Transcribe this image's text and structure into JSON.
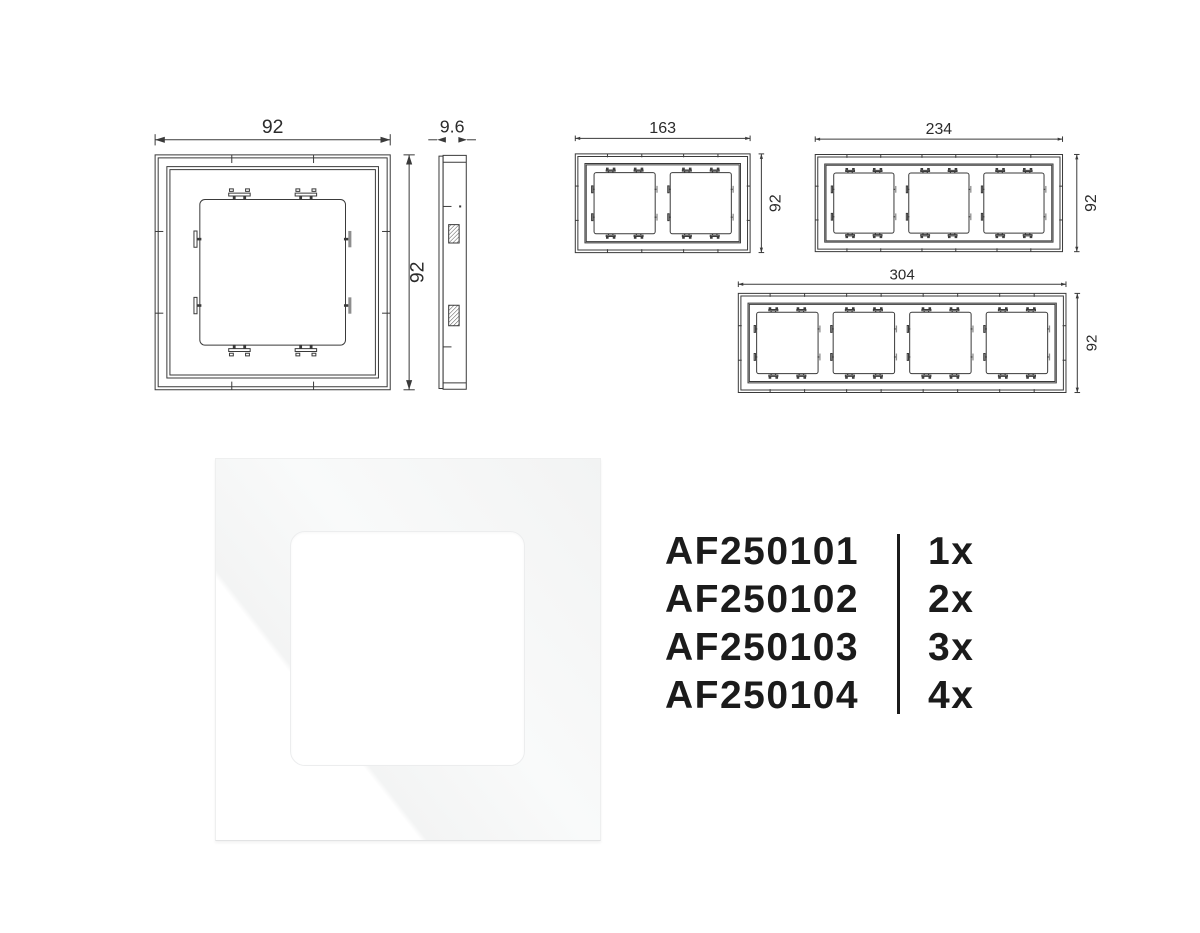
{
  "colors": {
    "background": "#ffffff",
    "drawing_line": "#3a3a3a",
    "dimension_text": "#2b2b2b",
    "table_text": "#1b1b1b"
  },
  "dimensions": {
    "front_1gang": {
      "width": "92",
      "height": "92"
    },
    "side_view": {
      "depth": "9.6"
    },
    "front_2gang": {
      "width": "163",
      "height": "92"
    },
    "front_3gang": {
      "width": "234",
      "height": "92"
    },
    "front_4gang": {
      "width": "304",
      "height": "92"
    }
  },
  "product_table": {
    "rows": [
      {
        "code": "AF250101",
        "quantity": "1x"
      },
      {
        "code": "AF250102",
        "quantity": "2x"
      },
      {
        "code": "AF250103",
        "quantity": "3x"
      },
      {
        "code": "AF250104",
        "quantity": "4x"
      }
    ]
  }
}
